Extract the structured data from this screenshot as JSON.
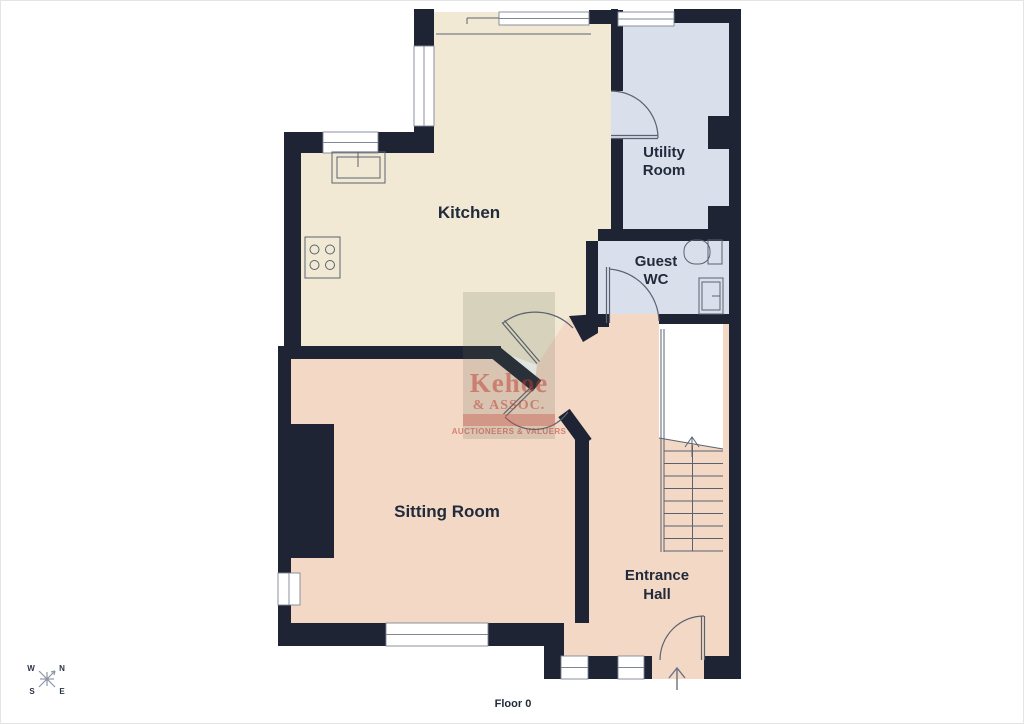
{
  "floor": {
    "label": "Floor 0"
  },
  "rooms": {
    "kitchen": {
      "label": "Kitchen"
    },
    "utility": {
      "line1": "Utility",
      "line2": "Room"
    },
    "guest_wc": {
      "line1": "Guest",
      "line2": "WC"
    },
    "sitting": {
      "label": "Sitting Room"
    },
    "hall": {
      "line1": "Entrance",
      "line2": "Hall"
    }
  },
  "compass": {
    "n": "N",
    "e": "E",
    "s": "S",
    "w": "W"
  },
  "watermark": {
    "name": "Kehoe",
    "suffix": "& ASSOC.",
    "tagline": "AUCTIONEERS & VALUERS"
  },
  "colors": {
    "wall": "#1e2433",
    "kitchen": "#f1e9d4",
    "utility": "#d9dfeb",
    "living": "#f3d8c6",
    "accent_red": "#bc3a30"
  }
}
